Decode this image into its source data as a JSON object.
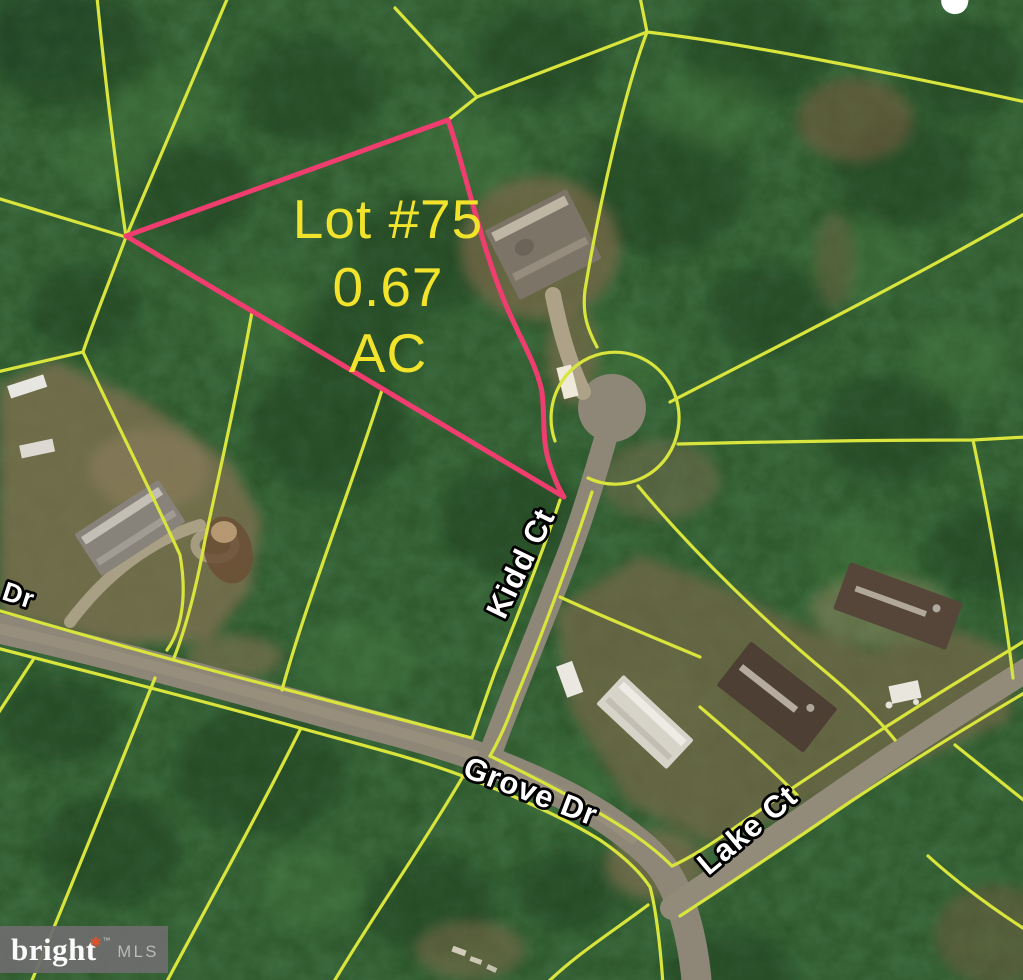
{
  "map": {
    "lot_label": {
      "line1": "Lot #75",
      "line2": "0.67",
      "line3": "AC"
    },
    "streets": {
      "kidd": "Kidd Ct",
      "grove": "Grove Dr",
      "lake": "Lake Ct",
      "partial": "Dr"
    }
  },
  "watermark": {
    "brand": "bright",
    "star": "✱",
    "tm": "™",
    "suffix": "MLS"
  },
  "colors": {
    "forest": "#2b5429",
    "clearing": "#7a6b4b",
    "road": "#8e8677",
    "parcel_line": "#d9e53c",
    "lot_line": "#ee3d6e",
    "lot_text": "#f2e32b",
    "street_text": "#ffffff",
    "street_outline": "#000000",
    "watermark_bg": "#6c6c6c",
    "watermark_star": "#e05328"
  }
}
